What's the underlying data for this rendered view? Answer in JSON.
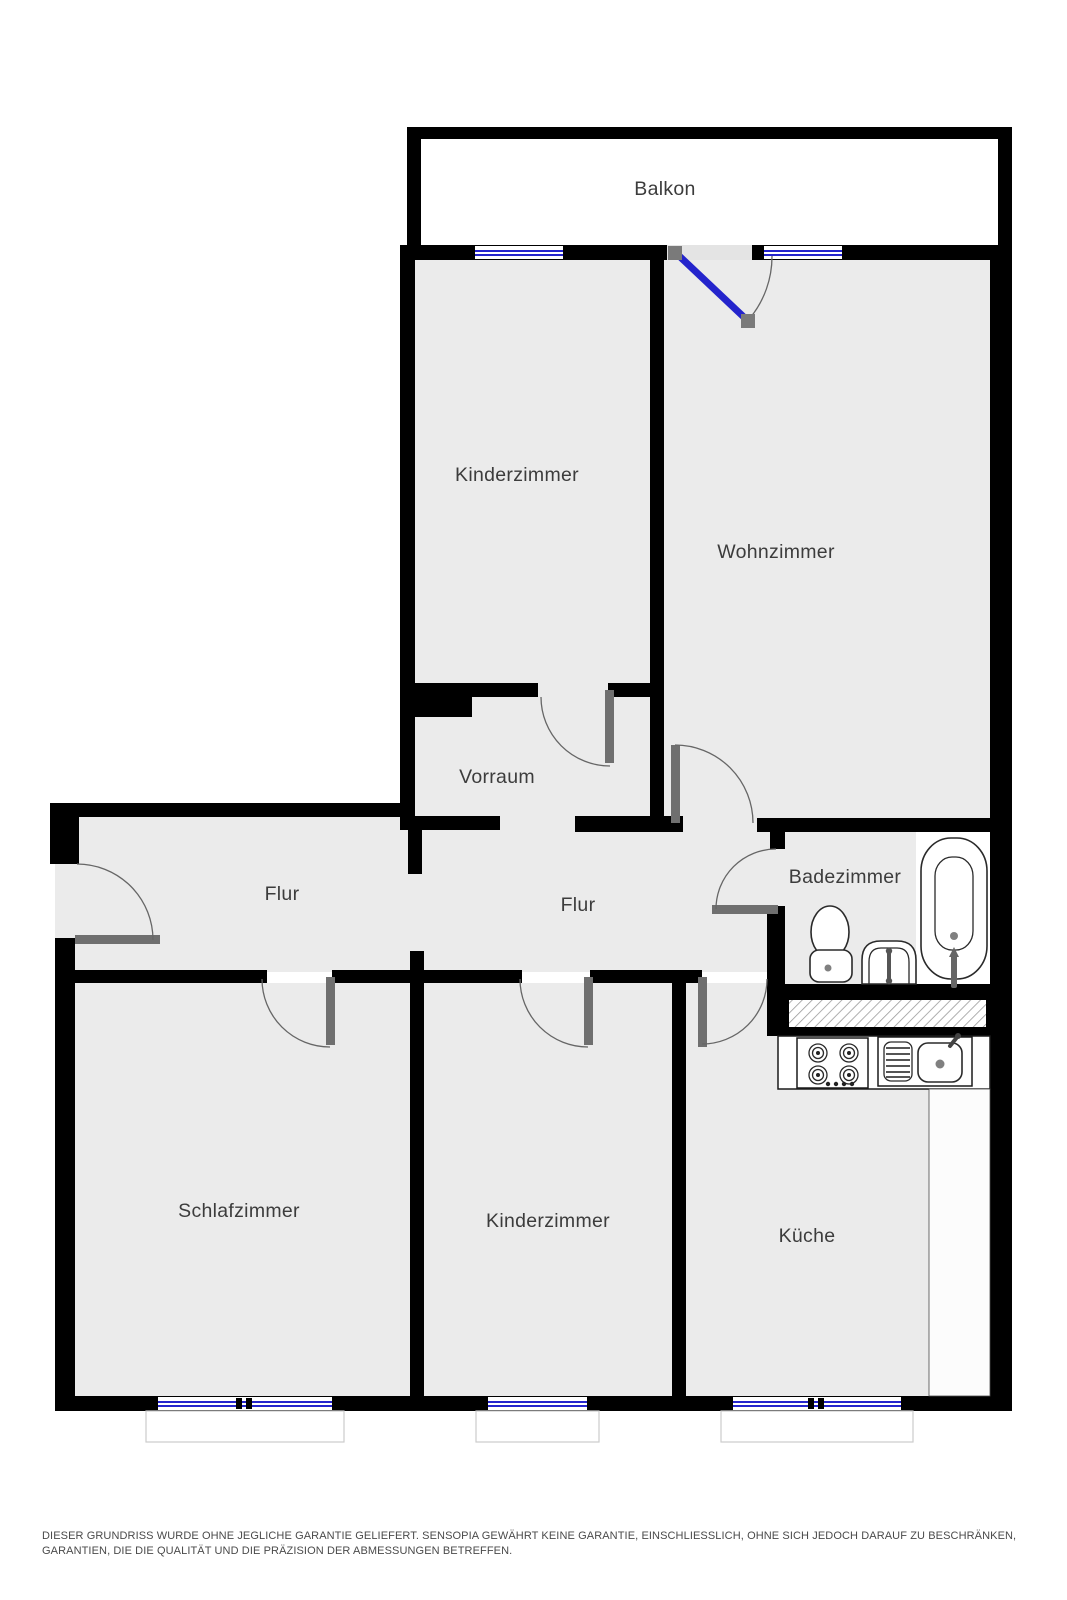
{
  "rooms": {
    "balkon": "Balkon",
    "kinderzimmer_top": "Kinderzimmer",
    "wohnzimmer": "Wohnzimmer",
    "vorraum": "Vorraum",
    "flur_left": "Flur",
    "flur_middle": "Flur",
    "badezimmer": "Badezimmer",
    "schlafzimmer": "Schlafzimmer",
    "kinderzimmer_bottom": "Kinderzimmer",
    "kueche": "Küche"
  },
  "disclaimer": "DIESER GRUNDRISS WURDE OHNE JEGLICHE GARANTIE GELIEFERT. SENSOPIA GEWÄHRT KEINE GARANTIE, EINSCHLIESSLICH, OHNE SICH JEDOCH DARAUF ZU BESCHRÄNKEN, GARANTIEN, DIE DIE QUALITÄT UND DIE PRÄZISION DER ABMESSUNGEN BETREFFEN.",
  "icons": {
    "bathtub": "bathtub-icon",
    "toilet": "toilet-icon",
    "washbasin": "washbasin-icon",
    "stove": "stove-icon",
    "kitchen_sink": "kitchen-sink-icon",
    "door_swing": "door-swing-icon",
    "window": "window-icon",
    "shaft_hatch": "shaft-hatch-icon"
  },
  "colors": {
    "wall": "#000000",
    "floor": "#ebebeb",
    "balcony": "#ffffff",
    "window_blue": "#2424cc",
    "door_leaf": "#6f6f6f",
    "arc": "#666666",
    "label": "#3c3c3c",
    "disclaimer": "#4a4a4a",
    "fixture": "#2a2a2a",
    "hatch": "#9a9a9a",
    "sill_border": "#cccccc",
    "counter_stroke": "#1a1a1a"
  }
}
